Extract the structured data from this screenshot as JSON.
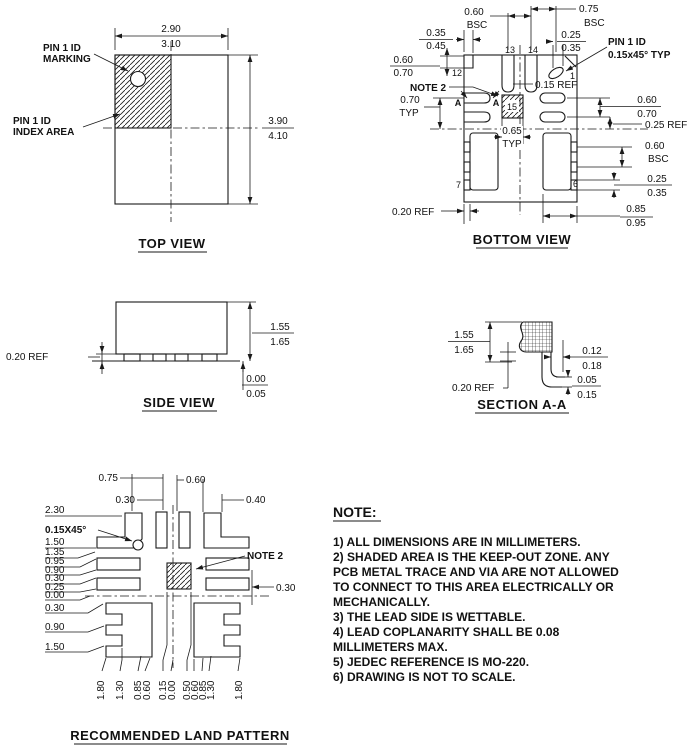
{
  "top_view": {
    "title": "TOP VIEW",
    "pin1_marking": [
      "PIN 1 ID",
      "MARKING"
    ],
    "pin1_index": [
      "PIN 1 ID",
      "INDEX AREA"
    ],
    "width": [
      "2.90",
      "3.10"
    ],
    "height": [
      "3.90",
      "4.10"
    ]
  },
  "bottom_view": {
    "title": "BOTTOM VIEW",
    "pin1_note": [
      "PIN 1 ID",
      "0.15x45° TYP"
    ],
    "note2": "NOTE 2",
    "section_marker": "A",
    "pins": {
      "p1": "1",
      "p6": "6",
      "p7": "7",
      "p12": "12",
      "p13": "13",
      "p14": "14",
      "p15": "15"
    },
    "dims": {
      "top_pitch_a": [
        "0.60",
        "BSC"
      ],
      "top_pitch_b": [
        "0.75",
        "BSC"
      ],
      "notch_w": [
        "0.35",
        "0.45"
      ],
      "chamfer_w": [
        "0.25",
        "0.35"
      ],
      "notch_h": [
        "0.60",
        "0.70"
      ],
      "row_pitch": [
        "0.70",
        "TYP"
      ],
      "pad_gap": "0.15 REF",
      "epad": [
        "0.65",
        "TYP"
      ],
      "slot": [
        "0.60",
        "0.70"
      ],
      "center_ref": "0.25 REF",
      "bump_pitch": [
        "0.60",
        "BSC"
      ],
      "bump": [
        "0.25",
        "0.35"
      ],
      "pad_edge": [
        "0.85",
        "0.95"
      ],
      "corner_ref": "0.20 REF"
    }
  },
  "side_view": {
    "title": "SIDE VIEW",
    "body_h": [
      "1.55",
      "1.65"
    ],
    "standoff": [
      "0.00",
      "0.05"
    ],
    "lead_t": "0.20 REF"
  },
  "section": {
    "title": "SECTION A-A",
    "body_h": [
      "1.55",
      "1.65"
    ],
    "lead_w": [
      "0.12",
      "0.18"
    ],
    "foot": [
      "0.05",
      "0.15"
    ],
    "lead_t": "0.20 REF"
  },
  "land_pattern": {
    "title": "RECOMMENDED LAND PATTERN",
    "note2": "NOTE 2",
    "chamfer": "0.15X45°",
    "top_dims": [
      "0.75",
      "0.30",
      "0.60",
      "0.40"
    ],
    "right_dim": "0.30",
    "left_dims": [
      "2.30",
      "1.50",
      "1.35",
      "0.95",
      "0.90",
      "0.30",
      "0.25",
      "0.00",
      "0.30",
      "0.90",
      "1.50"
    ],
    "bottom_dims": [
      "1.80",
      "1.30",
      "0.85",
      "0.60",
      "0.15",
      "0.00",
      "0.50",
      "0.60",
      "0.85",
      "1.30",
      "1.80"
    ]
  },
  "notes": {
    "heading": "NOTE:",
    "lines": [
      "1) ALL DIMENSIONS ARE IN MILLIMETERS.",
      "2) SHADED AREA IS THE KEEP-OUT ZONE. ANY",
      "PCB METAL TRACE AND VIA ARE NOT ALLOWED",
      "TO CONNECT TO THIS AREA ELECTRICALLY OR",
      "MECHANICALLY.",
      "3) THE LEAD SIDE IS WETTABLE.",
      "4) LEAD COPLANARITY SHALL BE 0.08",
      "MILLIMETERS MAX.",
      "5) JEDEC REFERENCE IS MO-220.",
      "6) DRAWING IS NOT TO SCALE."
    ]
  }
}
